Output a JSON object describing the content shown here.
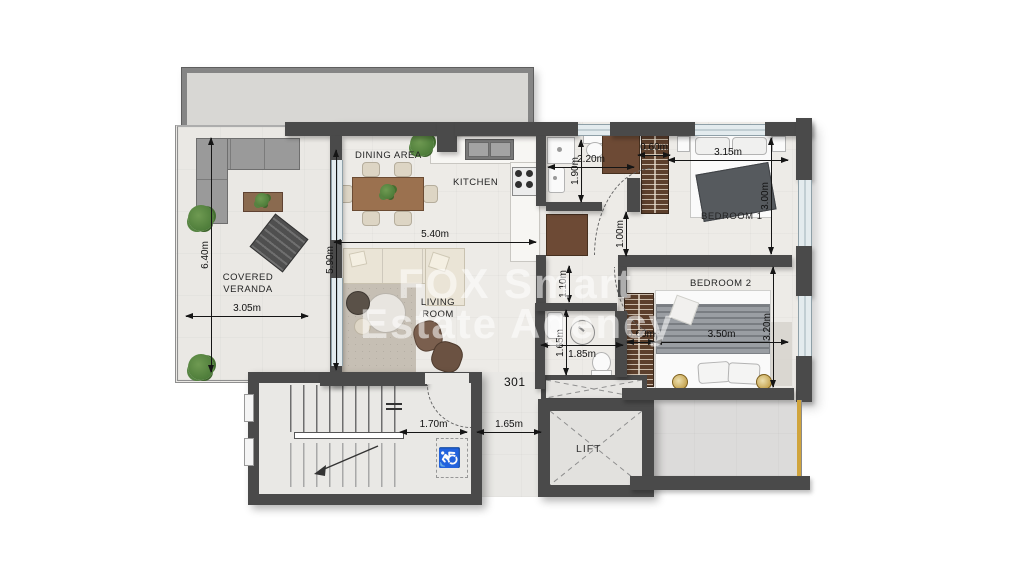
{
  "apartment": {
    "number": "301"
  },
  "watermark": {
    "line1": "FOX Smart",
    "line2": "Estate Agency"
  },
  "rooms": {
    "veranda_line1": "COVERED",
    "veranda_line2": "VERANDA",
    "dining": "DINING AREA",
    "kitchen": "KITCHEN",
    "living_line1": "LIVING",
    "living_line2": "ROOM",
    "bedroom1": "BEDROOM 1",
    "bedroom2": "BEDROOM 2",
    "lift": "LIFT"
  },
  "dims": {
    "veranda_height": "6.40m",
    "veranda_width": "3.05m",
    "living_height": "5.90m",
    "living_width": "5.40m",
    "bath1_width": "2.20m",
    "bath1_height": "1.90m",
    "wardrobe1_width": "0.60m",
    "bedroom1_width": "3.15m",
    "bedroom1_height": "3.00m",
    "corridor_width": "1.00m",
    "hall_width": "1.10m",
    "wc_height": "1.65m",
    "wc_width": "1.85m",
    "wardrobe2_width": "0.60m",
    "bedroom2_width": "3.50m",
    "bedroom2_height": "3.20m",
    "stair_landing_width": "1.70m",
    "entry_lobby_width": "1.65m"
  },
  "colors": {
    "wall": "#4a4a4a",
    "wardrobe": "#5c3f2c",
    "cabinet": "#6d4a35",
    "plant": "#4e7d3a",
    "lamp_gold": "#b98f2f",
    "railing_gold": "#d0a43c",
    "glass": "#e3ebee",
    "dim": "#151515"
  }
}
